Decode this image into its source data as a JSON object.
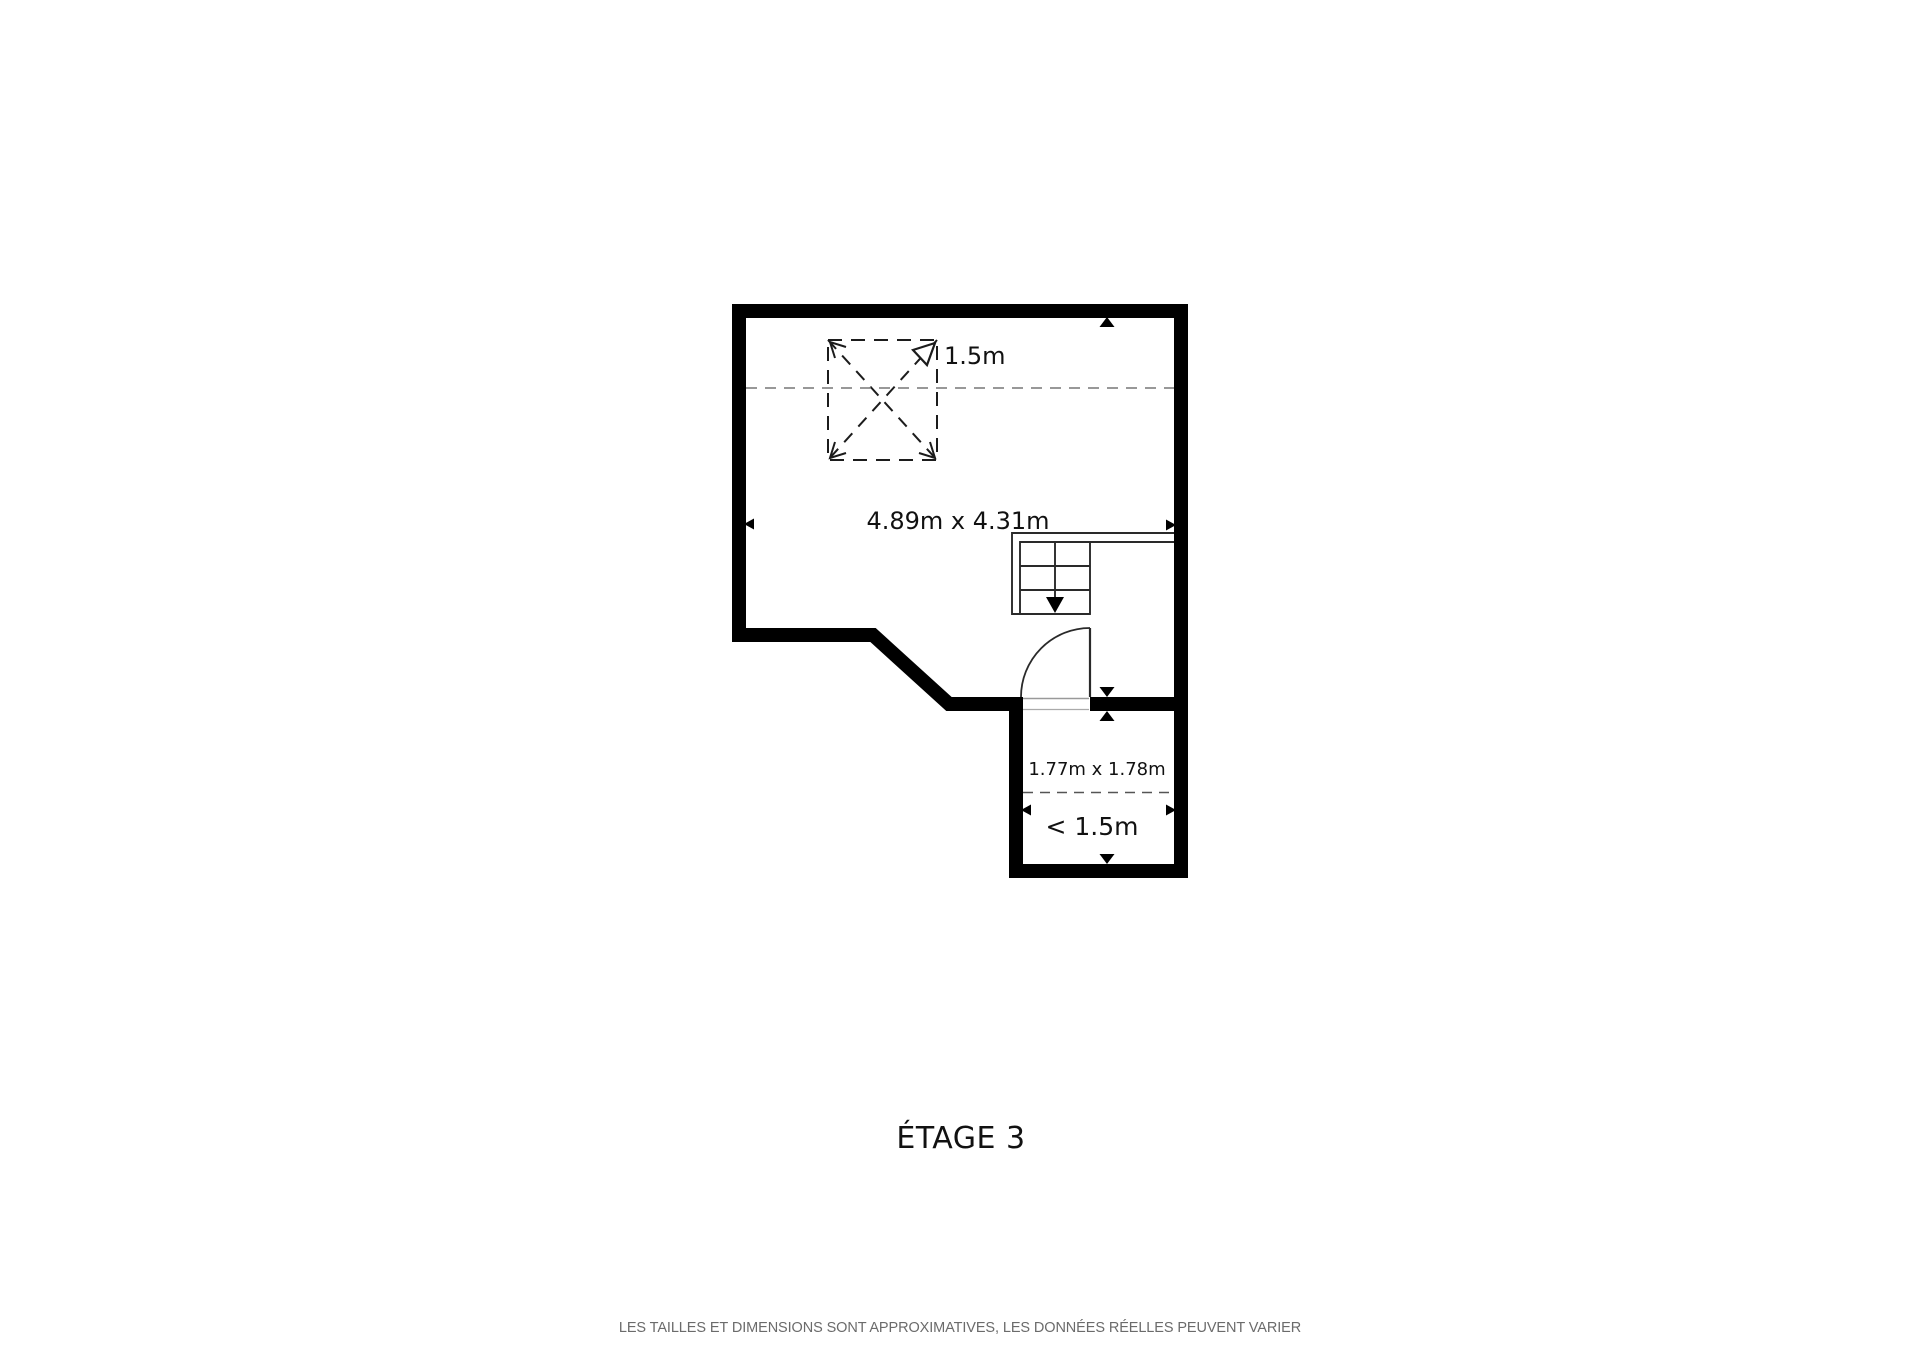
{
  "floor_plan": {
    "skylight": {
      "label": "1.5m"
    },
    "main_room": {
      "dimensions": "4.89m x 4.31m"
    },
    "small_room": {
      "dimensions": "1.77m x 1.78m",
      "ceiling_height_label": "< 1.5m"
    },
    "title": "ÉTAGE 3",
    "disclaimer": "LES TAILLES ET DIMENSIONS SONT APPROXIMATIVES, LES DONNÉES RÉELLES PEUVENT VARIER",
    "colors": {
      "wall": "#000000",
      "thin_line": "#2a2a2a",
      "dashed_ceiling_line": "#777777",
      "text": "#111111",
      "disclaimer_text": "#6b6b6b",
      "background": "#ffffff"
    }
  }
}
